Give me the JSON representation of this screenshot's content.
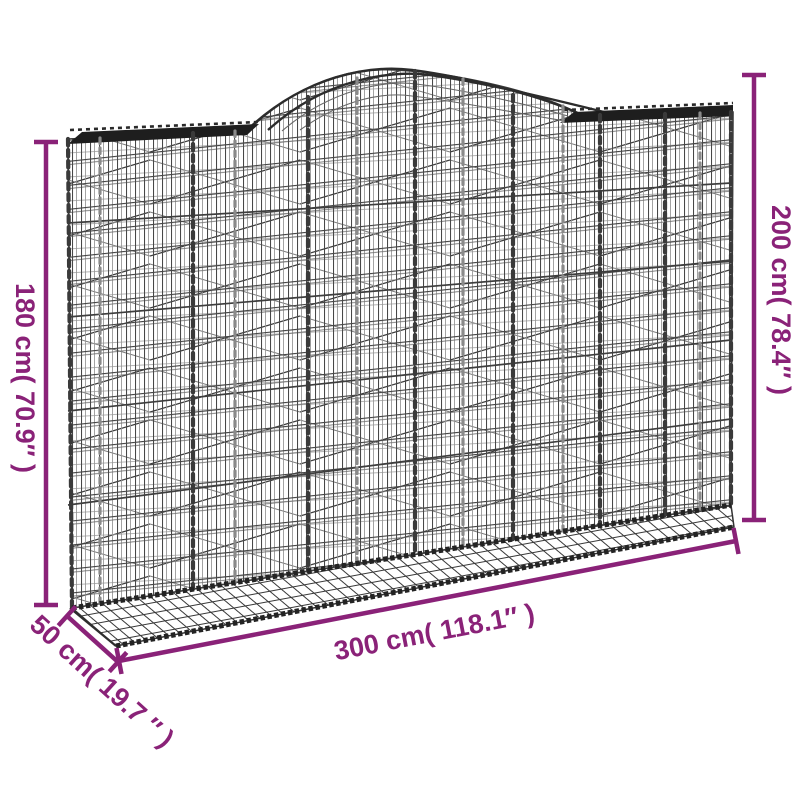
{
  "page": {
    "type": "product-dimension-diagram",
    "subject": "arched gabion wire basket",
    "background": "#ffffff"
  },
  "labels": {
    "height_left": "180 cm( 70.9″ )",
    "height_right": "200 cm( 78.4″ )",
    "width_bottom": "300 cm( 118.1″ )",
    "depth_left": "50 cm( 19.7 ″ )"
  },
  "colors": {
    "dimension_accent": "#8A2278",
    "wire_dark": "#3a3a3a",
    "wire_light": "#8f8f8f",
    "rim_dark": "#1e1e1e"
  }
}
